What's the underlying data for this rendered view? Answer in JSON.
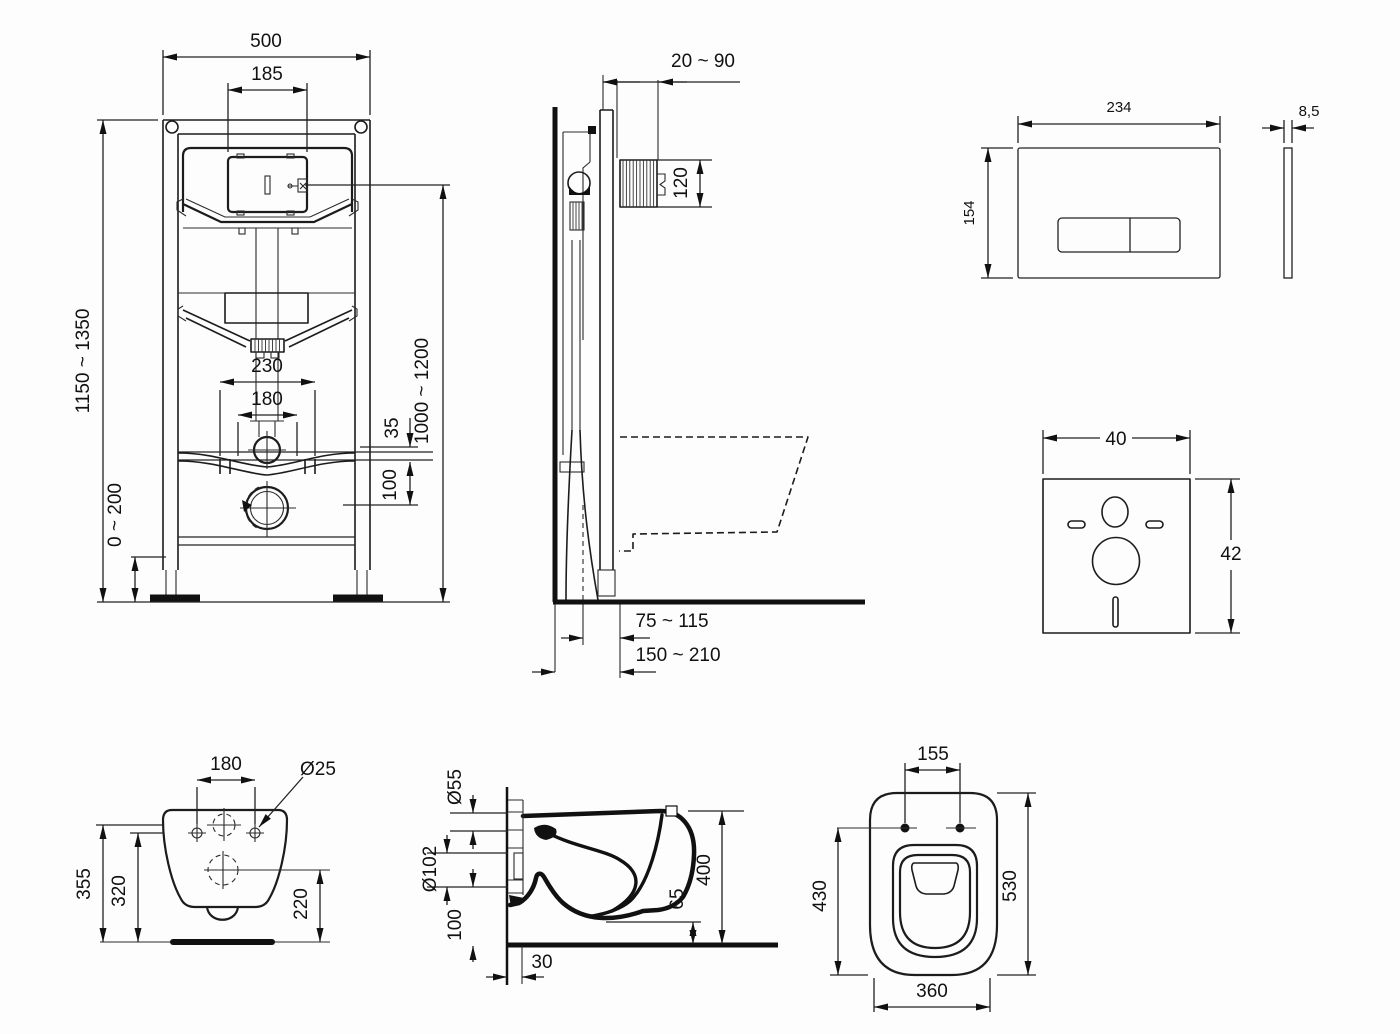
{
  "drawing": {
    "frame_front": {
      "width": "500",
      "tank_width": "185",
      "height_range": "1150 ~ 1350",
      "hole_spacing_outer": "230",
      "hole_spacing_inner": "180",
      "inlet_offset": "35",
      "outlet_offset": "100",
      "foot_adjustment": "0 ~ 200",
      "flush_height_range": "1000 ~ 1200"
    },
    "frame_side": {
      "wall_clearance": "20 ~ 90",
      "flush_bend_height": "120",
      "outlet_to_wall": "75 ~ 115",
      "depth_range": "150 ~ 210"
    },
    "flush_plate": {
      "width": "234",
      "height": "154",
      "thickness": "8,5"
    },
    "sound_pad": {
      "width": "40",
      "height": "42"
    },
    "bowl_rear": {
      "hole_spacing": "180",
      "hole_diameter": "Ø25",
      "height_total": "355",
      "height_holes": "320",
      "height_outlet": "220"
    },
    "bowl_side": {
      "inlet_diameter": "Ø55",
      "outlet_diameter": "Ø102",
      "outlet_height": "100",
      "outlet_wall_offset": "30",
      "front_clearance": "65",
      "depth": "400"
    },
    "bowl_top": {
      "seat_hole_spacing": "155",
      "length_to_holes": "430",
      "length_total": "530",
      "width": "360"
    }
  }
}
